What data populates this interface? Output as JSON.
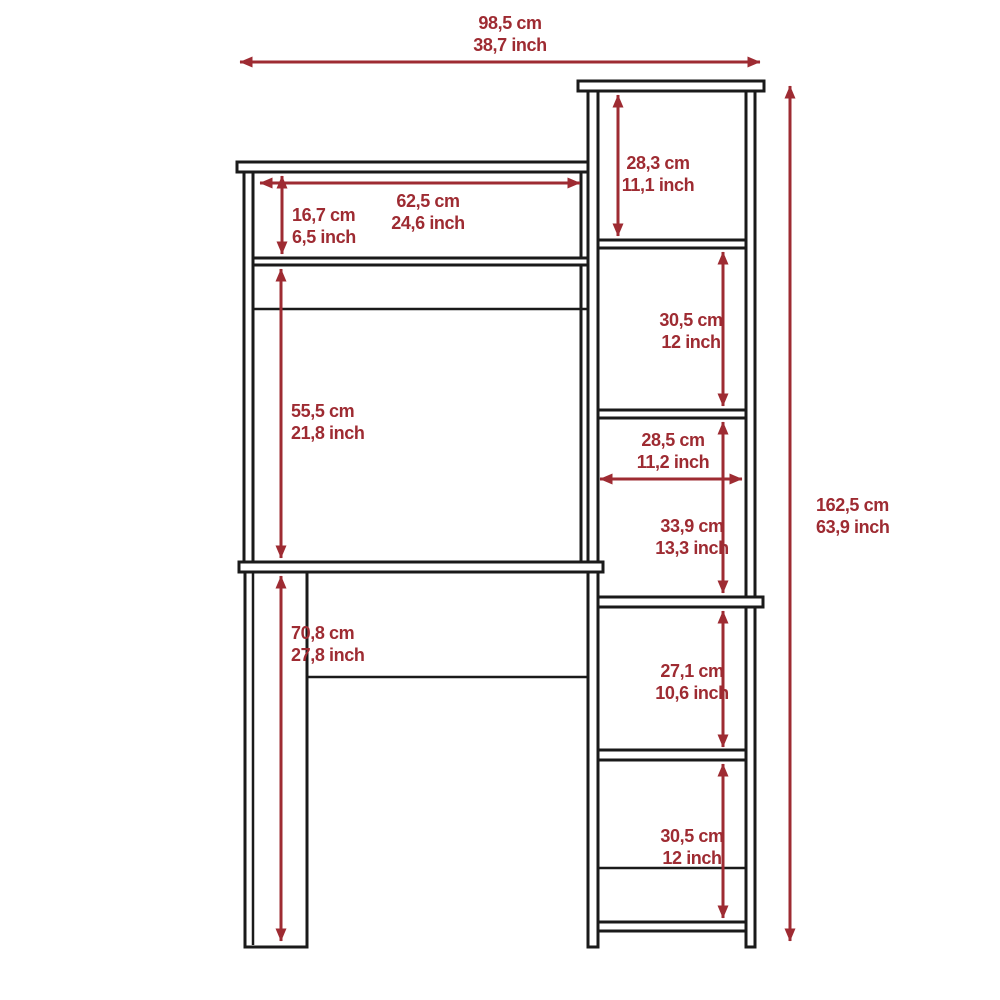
{
  "figure": "furniture-dimension-diagram",
  "colors": {
    "dimension_red": "#9E2B32",
    "line_black": "#1A1A1A",
    "background": "#FFFFFF"
  },
  "units": {
    "metric": "cm",
    "imperial": "inch"
  },
  "dimensions": {
    "overall_width": {
      "cm": "98,5 cm",
      "inch": "38,7 inch"
    },
    "hutch_shelf_width": {
      "cm": "62,5 cm",
      "inch": "24,6 inch"
    },
    "hutch_shelf_height": {
      "cm": "16,7 cm",
      "inch": "6,5 inch"
    },
    "bookcase_cubby_1": {
      "cm": "28,3 cm",
      "inch": "11,1 inch"
    },
    "bookcase_cubby_2": {
      "cm": "30,5 cm",
      "inch": "12 inch"
    },
    "bookcase_inner_width": {
      "cm": "28,5 cm",
      "inch": "11,2 inch"
    },
    "bookcase_cubby_3": {
      "cm": "33,9 cm",
      "inch": "13,3 inch"
    },
    "bookcase_cubby_4": {
      "cm": "27,1 cm",
      "inch": "10,6 inch"
    },
    "bookcase_cubby_5": {
      "cm": "30,5 cm",
      "inch": "12 inch"
    },
    "desk_clearance_height": {
      "cm": "55,5 cm",
      "inch": "21,8 inch"
    },
    "desk_total_height": {
      "cm": "70,8 cm",
      "inch": "27,8 inch"
    },
    "overall_height": {
      "cm": "162,5 cm",
      "inch": "63,9 inch"
    }
  }
}
